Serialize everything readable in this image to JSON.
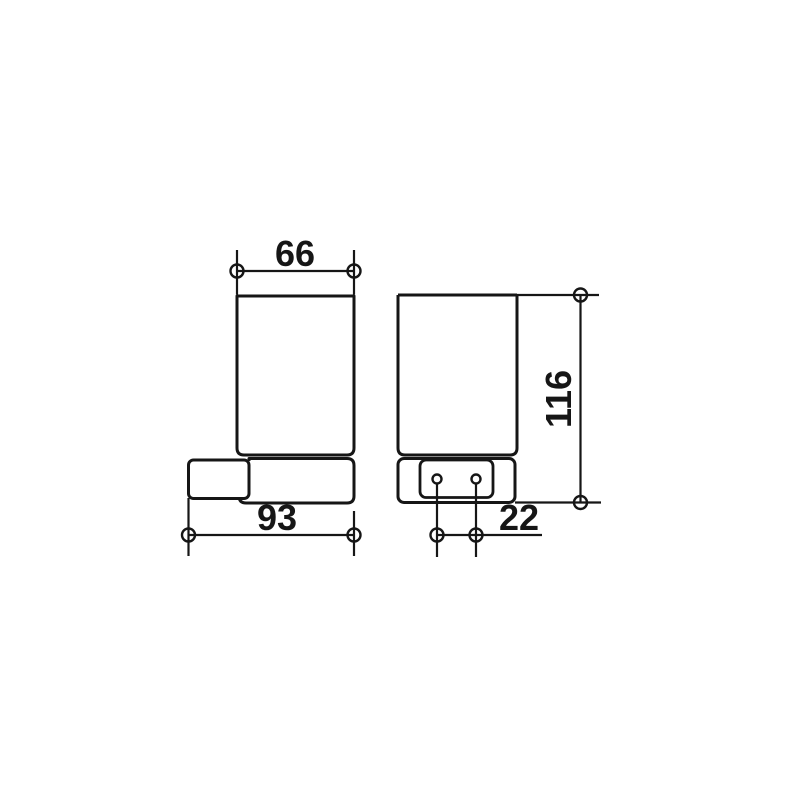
{
  "background": "#ffffff",
  "line_color": "#161616",
  "drawing": {
    "kind": "technical-dimension-drawing",
    "dimensions": {
      "cup_width": {
        "value": "66",
        "orientation": "horizontal",
        "view": "front"
      },
      "wall_projection": {
        "value": "93",
        "orientation": "horizontal",
        "view": "front"
      },
      "overall_height": {
        "value": "116",
        "orientation": "vertical",
        "view": "side"
      },
      "hole_spacing": {
        "value": "22",
        "orientation": "horizontal",
        "view": "side"
      }
    }
  }
}
